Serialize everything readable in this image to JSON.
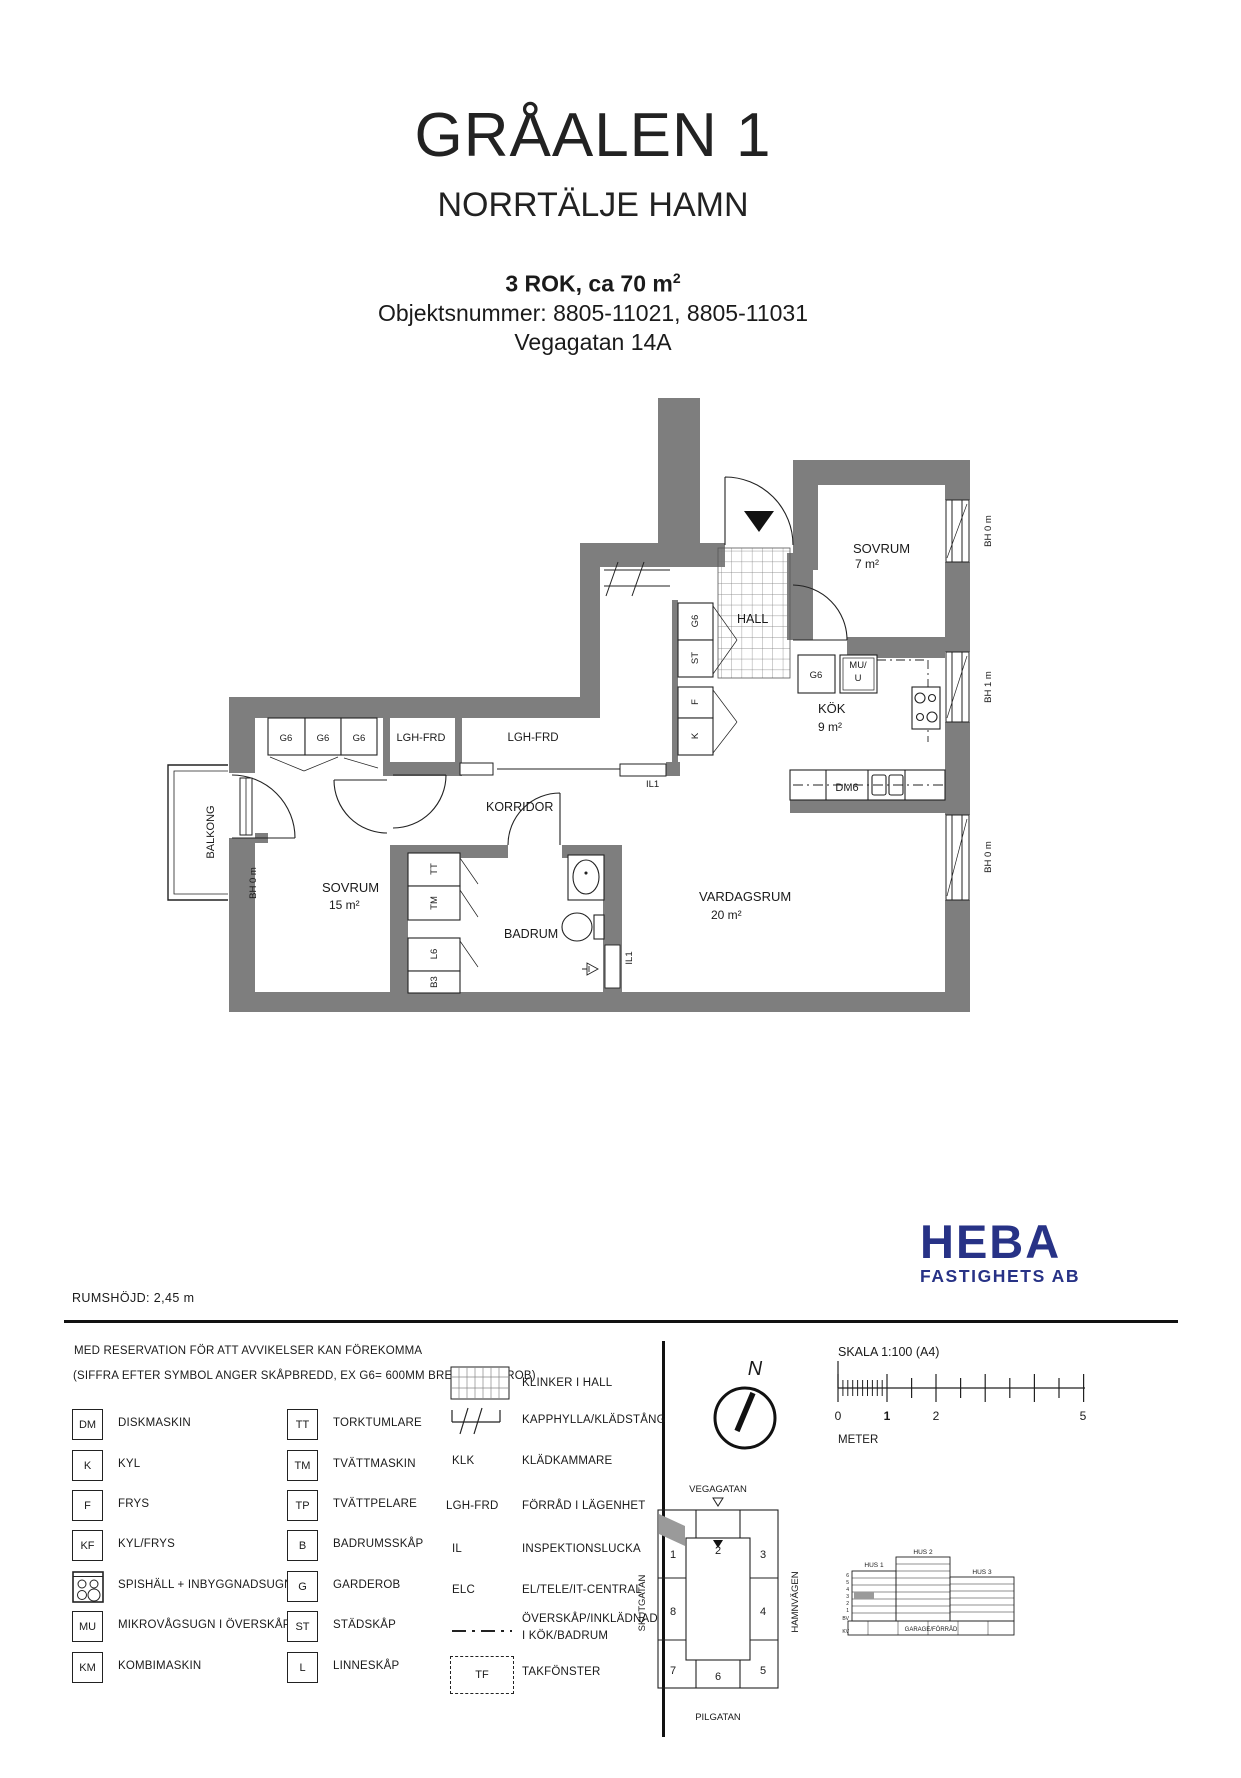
{
  "header": {
    "title": "GRÅALEN 1",
    "subtitle": "NORRTÄLJE HAMN",
    "rok_line": "3 ROK, ca 70 m",
    "rok_sup": "2",
    "objekt_line": "Objektsnummer: 8805-11021, 8805-11031",
    "address": "Vegagatan 14A"
  },
  "floorplan": {
    "sovrum7_name": "SOVRUM",
    "sovrum7_area": "7 m²",
    "kok_name": "KÖK",
    "kok_area": "9 m²",
    "sovrum15_name": "SOVRUM",
    "sovrum15_area": "15 m²",
    "vardagsrum_name": "VARDAGSRUM",
    "vardagsrum_area": "20 m²",
    "hall": "HALL",
    "korridor": "KORRIDOR",
    "badrum": "BADRUM",
    "balkong": "BALKONG",
    "g6": "G6",
    "st": "ST",
    "f": "F",
    "k": "K",
    "mu_line1": "MU/",
    "mu_line2": "U",
    "dm6": "DM6",
    "lgh_frd": "LGH-FRD",
    "il1": "IL1",
    "tt": "TT",
    "tm": "TM",
    "l6": "L6",
    "b3": "B3",
    "bh0": "BH 0 m",
    "bh1": "BH 1 m"
  },
  "logo": {
    "name": "HEBA",
    "sub": "FASTIGHETS AB",
    "color": "#273286"
  },
  "info": {
    "room_height": "RUMSHÖJD: 2,45 m"
  },
  "legend": {
    "note1": "MED RESERVATION FÖR ATT AVVIKELSER KAN FÖREKOMMA",
    "note2": "(SIFFRA EFTER SYMBOL ANGER SKÅPBREDD, EX G6= 600MM BRED GARDEROB)",
    "col1": [
      {
        "sym": "DM",
        "label": "DISKMASKIN"
      },
      {
        "sym": "K",
        "label": "KYL"
      },
      {
        "sym": "F",
        "label": "FRYS"
      },
      {
        "sym": "KF",
        "label": "KYL/FRYS"
      },
      {
        "sym": "",
        "label": "SPISHÄLL + INBYGGNADSUGN"
      },
      {
        "sym": "MU",
        "label": "MIKROVÅGSUGN I ÖVERSKÅP"
      },
      {
        "sym": "KM",
        "label": "KOMBIMASKIN"
      }
    ],
    "col2": [
      {
        "sym": "TT",
        "label": "TORKTUMLARE"
      },
      {
        "sym": "TM",
        "label": "TVÄTTMASKIN"
      },
      {
        "sym": "TP",
        "label": "TVÄTTPELARE"
      },
      {
        "sym": "B",
        "label": "BADRUMSSKÅP"
      },
      {
        "sym": "G",
        "label": "GARDEROB"
      },
      {
        "sym": "ST",
        "label": "STÄDSKÅP"
      },
      {
        "sym": "L",
        "label": "LINNESKÅP"
      }
    ],
    "col3": [
      {
        "sym": "",
        "label": "KLINKER I HALL"
      },
      {
        "sym": "",
        "label": "KAPPHYLLA/KLÄDSTÅNG"
      },
      {
        "sym": "KLK",
        "label": "KLÄDKAMMARE"
      },
      {
        "sym": "LGH-FRD",
        "label": "FÖRRÅD I LÄGENHET"
      },
      {
        "sym": "IL",
        "label": "INSPEKTIONSLUCKA"
      },
      {
        "sym": "ELC",
        "label": "EL/TELE/IT-CENTRAL"
      },
      {
        "sym": "",
        "label": "ÖVERSKÅP/INKLÄDNAD",
        "label2": "I KÖK/BADRUM"
      },
      {
        "sym": "TF",
        "label": "TAKFÖNSTER"
      }
    ]
  },
  "scale": {
    "label": "SKALA 1:100 (A4)",
    "tick0": "0",
    "tick1": "1",
    "tick2": "2",
    "tick5": "5",
    "unit": "METER"
  },
  "compass": {
    "north": "N"
  },
  "siteplan": {
    "street_top": "VEGAGATAN",
    "street_left": "SKUTGATAN",
    "street_right": "HAMNVÄGEN",
    "street_bottom": "PILGATAN",
    "units": [
      "1",
      "2",
      "3",
      "8",
      "4",
      "7",
      "6",
      "5"
    ]
  },
  "elevation": {
    "hus1": "HUS 1",
    "hus2": "HUS 2",
    "hus3": "HUS 3",
    "floors": [
      "6",
      "5",
      "4",
      "3",
      "2",
      "1",
      "BV",
      "KV"
    ],
    "garage": "GARAGE/FÖRRÅD"
  }
}
